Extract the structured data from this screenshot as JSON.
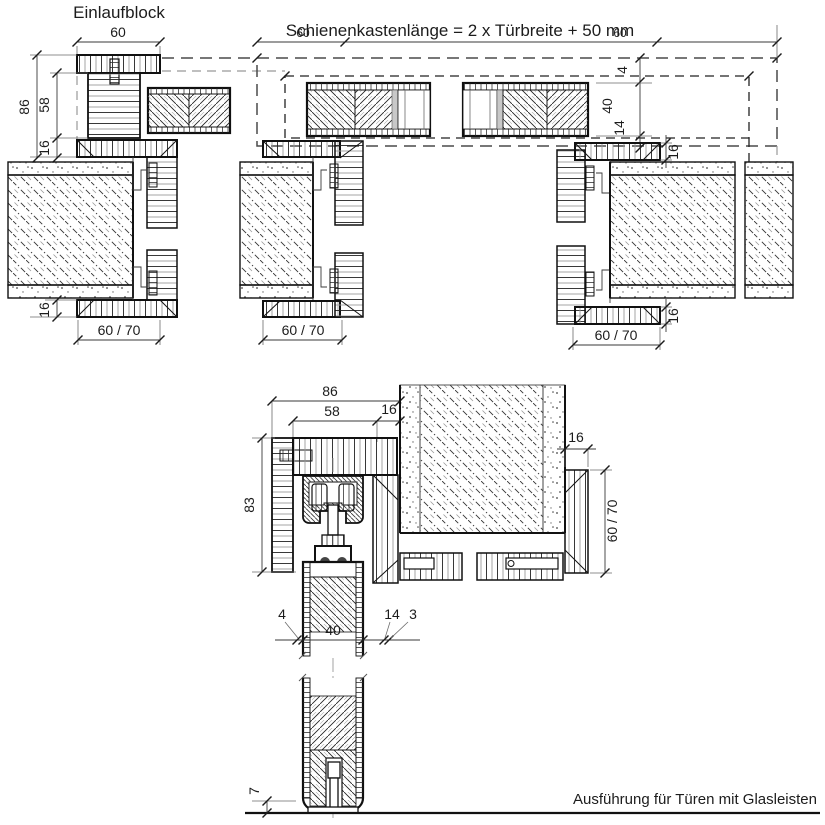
{
  "drawing": {
    "title_top_left": "Einlaufblock",
    "rail_formula": "Schienenkastenlänge = 2 x Türbreite + 50 mm",
    "footer_note": "Ausführung für Türen mit Glasleisten"
  },
  "dims": {
    "d60": "60",
    "d86": "86",
    "d58": "58",
    "d16": "16",
    "d6070": "60 / 70",
    "d4": "4",
    "d40": "40",
    "d14": "14",
    "d3": "3",
    "d83": "83",
    "d7": "7"
  },
  "colors": {
    "line": "#1c1c1c",
    "gray": "#999999",
    "background": "#ffffff"
  }
}
